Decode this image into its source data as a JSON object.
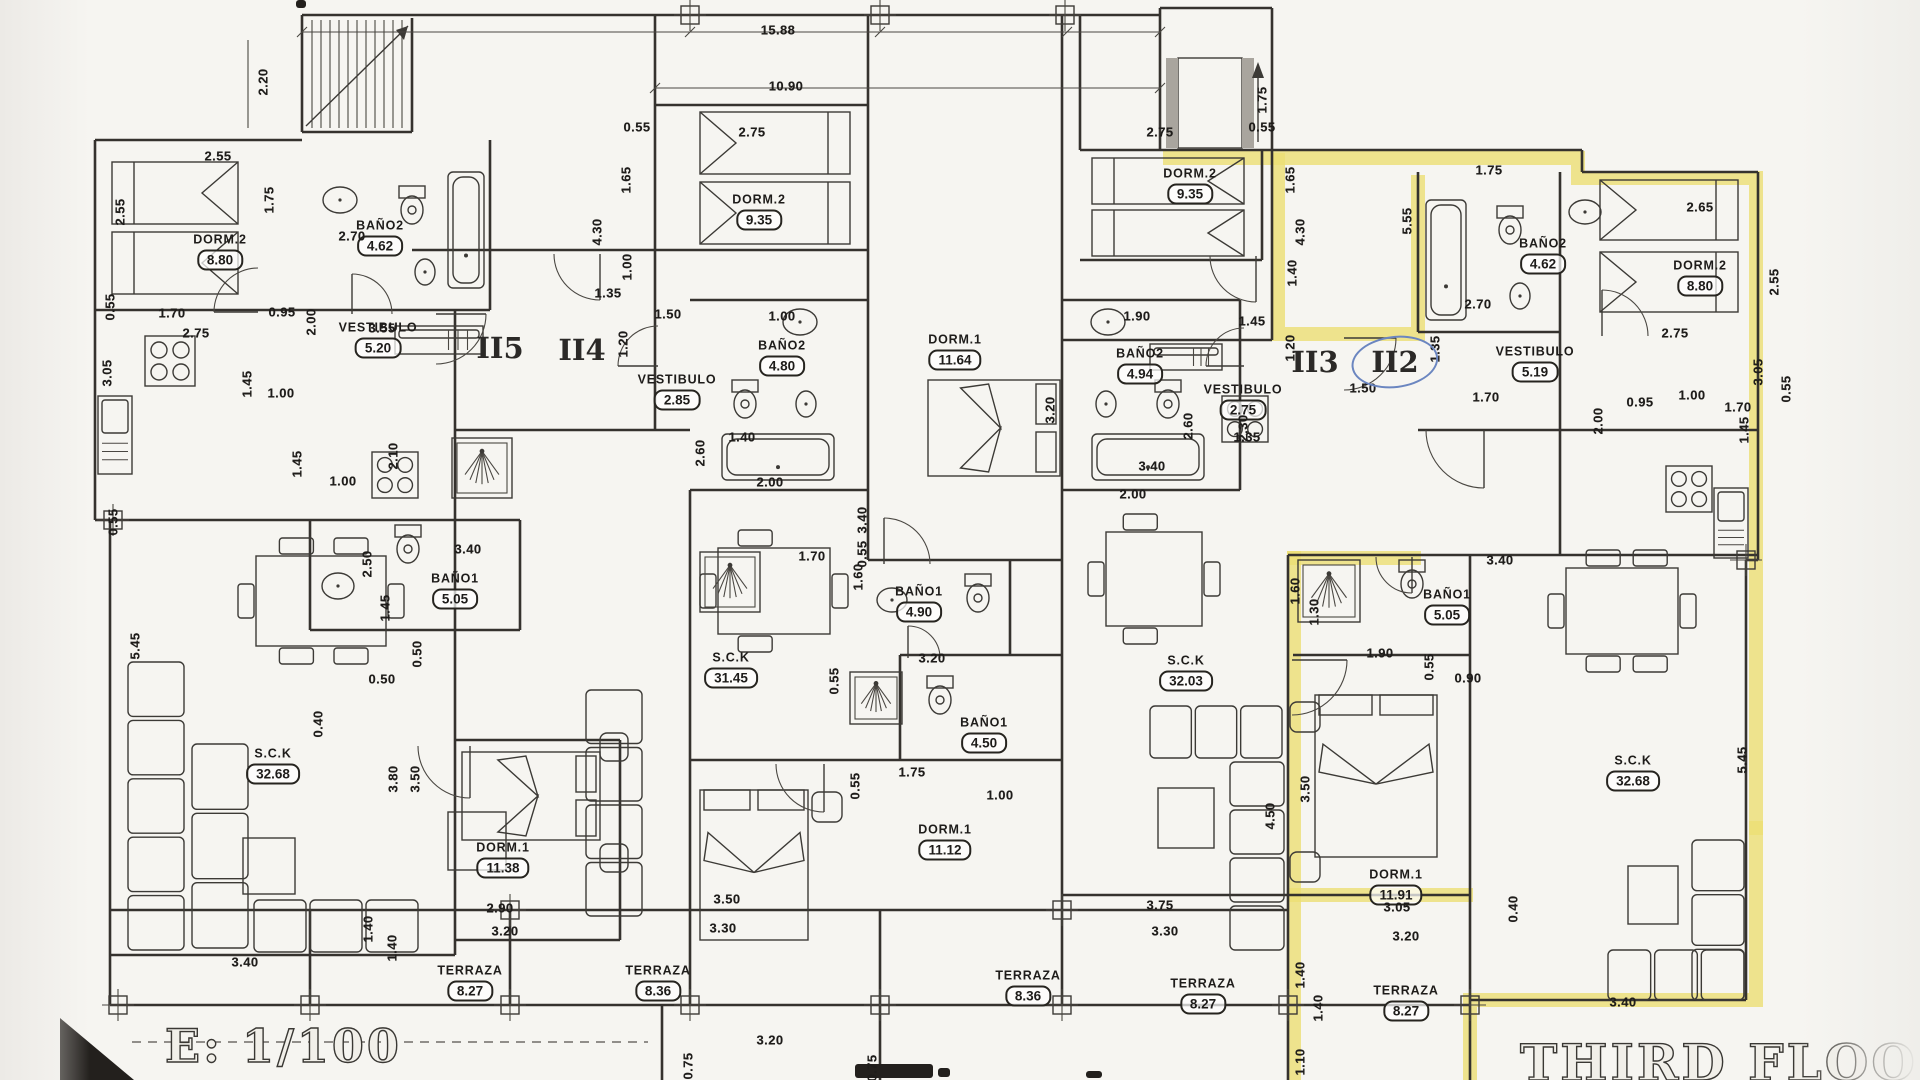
{
  "document": {
    "scale_label": "E: 1/100",
    "floor_title": "THIRD FLOOR"
  },
  "units": [
    {
      "label": "II5",
      "x": 500,
      "y": 348,
      "circled": false
    },
    {
      "label": "II4",
      "x": 582,
      "y": 350,
      "circled": false
    },
    {
      "label": "II3",
      "x": 1315,
      "y": 362,
      "circled": false
    },
    {
      "label": "II2",
      "x": 1395,
      "y": 362,
      "circled": true
    }
  ],
  "rooms": [
    {
      "name": "DORM.2",
      "area": "8.80",
      "x": 220,
      "y": 252
    },
    {
      "name": "BAÑO2",
      "area": "4.62",
      "x": 380,
      "y": 238
    },
    {
      "name": "VESTIBULO",
      "area": "5.20",
      "x": 378,
      "y": 340
    },
    {
      "name": "DORM.2",
      "area": "9.35",
      "x": 759,
      "y": 212
    },
    {
      "name": "BAÑO2",
      "area": "4.80",
      "x": 782,
      "y": 358
    },
    {
      "name": "VESTIBULO",
      "area": "2.85",
      "x": 677,
      "y": 392
    },
    {
      "name": "DORM.1",
      "area": "11.64",
      "x": 955,
      "y": 352
    },
    {
      "name": "DORM.2",
      "area": "9.35",
      "x": 1190,
      "y": 186
    },
    {
      "name": "BAÑO2",
      "area": "4.94",
      "x": 1140,
      "y": 366
    },
    {
      "name": "VESTIBULO",
      "area": "2.75",
      "x": 1243,
      "y": 402
    },
    {
      "name": "BAÑO2",
      "area": "4.62",
      "x": 1543,
      "y": 256
    },
    {
      "name": "VESTIBULO",
      "area": "5.19",
      "x": 1535,
      "y": 364
    },
    {
      "name": "DORM.2",
      "area": "8.80",
      "x": 1700,
      "y": 278
    },
    {
      "name": "BAÑO1",
      "area": "5.05",
      "x": 455,
      "y": 591
    },
    {
      "name": "S.C.K",
      "area": "32.68",
      "x": 273,
      "y": 766
    },
    {
      "name": "DORM.1",
      "area": "11.38",
      "x": 503,
      "y": 860
    },
    {
      "name": "TERRAZA",
      "area": "8.27",
      "x": 470,
      "y": 983
    },
    {
      "name": "S.C.K",
      "area": "31.45",
      "x": 731,
      "y": 670
    },
    {
      "name": "BAÑO1",
      "area": "4.90",
      "x": 919,
      "y": 604
    },
    {
      "name": "BAÑO1",
      "area": "4.50",
      "x": 984,
      "y": 735
    },
    {
      "name": "DORM.1",
      "area": "11.12",
      "x": 945,
      "y": 842
    },
    {
      "name": "TERRAZA",
      "area": "8.36",
      "x": 658,
      "y": 983
    },
    {
      "name": "S.C.K",
      "area": "32.03",
      "x": 1186,
      "y": 673
    },
    {
      "name": "BAÑO1",
      "area": "5.05",
      "x": 1447,
      "y": 607
    },
    {
      "name": "DORM.1",
      "area": "11.91",
      "x": 1396,
      "y": 887
    },
    {
      "name": "TERRAZA",
      "area": "8.36",
      "x": 1028,
      "y": 988
    },
    {
      "name": "TERRAZA",
      "area": "8.27",
      "x": 1203,
      "y": 996
    },
    {
      "name": "S.C.K",
      "area": "32.68",
      "x": 1633,
      "y": 773
    },
    {
      "name": "TERRAZA",
      "area": "8.27",
      "x": 1406,
      "y": 1003
    }
  ],
  "dimensions": [
    {
      "t": "15.88",
      "x": 778,
      "y": 30
    },
    {
      "t": "10.90",
      "x": 786,
      "y": 86
    },
    {
      "t": "2.20",
      "x": 263,
      "y": 82,
      "r": 90
    },
    {
      "t": "2.55",
      "x": 218,
      "y": 156
    },
    {
      "t": "2.55",
      "x": 120,
      "y": 212,
      "r": 90
    },
    {
      "t": "1.75",
      "x": 269,
      "y": 200,
      "r": 90
    },
    {
      "t": "2.70",
      "x": 352,
      "y": 236
    },
    {
      "t": "0.55",
      "x": 110,
      "y": 307,
      "r": 90
    },
    {
      "t": "1.70",
      "x": 172,
      "y": 313
    },
    {
      "t": "0.95",
      "x": 282,
      "y": 312
    },
    {
      "t": "2.00",
      "x": 311,
      "y": 322,
      "r": 90
    },
    {
      "t": "2.75",
      "x": 196,
      "y": 333
    },
    {
      "t": "3.55",
      "x": 382,
      "y": 328
    },
    {
      "t": "3.05",
      "x": 107,
      "y": 373,
      "r": 90
    },
    {
      "t": "1.45",
      "x": 247,
      "y": 384,
      "r": 90
    },
    {
      "t": "1.00",
      "x": 281,
      "y": 393
    },
    {
      "t": "2.10",
      "x": 393,
      "y": 456,
      "r": 90
    },
    {
      "t": "2.50",
      "x": 367,
      "y": 564,
      "r": 90
    },
    {
      "t": "3.40",
      "x": 468,
      "y": 549
    },
    {
      "t": "1.45",
      "x": 297,
      "y": 464,
      "r": 90
    },
    {
      "t": "1.00",
      "x": 343,
      "y": 481
    },
    {
      "t": "1.45",
      "x": 385,
      "y": 608,
      "r": 90
    },
    {
      "t": "0.50",
      "x": 382,
      "y": 679
    },
    {
      "t": "0.50",
      "x": 417,
      "y": 654,
      "r": 90
    },
    {
      "t": "0.55",
      "x": 113,
      "y": 522,
      "r": 90
    },
    {
      "t": "5.45",
      "x": 135,
      "y": 646,
      "r": 90
    },
    {
      "t": "3.80",
      "x": 393,
      "y": 779,
      "r": 90
    },
    {
      "t": "3.50",
      "x": 415,
      "y": 779,
      "r": 90
    },
    {
      "t": "0.40",
      "x": 318,
      "y": 724,
      "r": 90
    },
    {
      "t": "3.40",
      "x": 245,
      "y": 962
    },
    {
      "t": "1.40",
      "x": 368,
      "y": 929,
      "r": 90
    },
    {
      "t": "1.40",
      "x": 392,
      "y": 948,
      "r": 90
    },
    {
      "t": "2.90",
      "x": 500,
      "y": 908
    },
    {
      "t": "3.20",
      "x": 505,
      "y": 931
    },
    {
      "t": "0.55",
      "x": 637,
      "y": 127
    },
    {
      "t": "2.75",
      "x": 752,
      "y": 132
    },
    {
      "t": "1.65",
      "x": 626,
      "y": 180,
      "r": 90
    },
    {
      "t": "4.30",
      "x": 597,
      "y": 232,
      "r": 90
    },
    {
      "t": "1.00",
      "x": 627,
      "y": 267,
      "r": 90
    },
    {
      "t": "1.50",
      "x": 668,
      "y": 314
    },
    {
      "t": "1.00",
      "x": 782,
      "y": 316
    },
    {
      "t": "1.20",
      "x": 623,
      "y": 344,
      "r": 90
    },
    {
      "t": "1.35",
      "x": 608,
      "y": 293
    },
    {
      "t": "1.40",
      "x": 742,
      "y": 437
    },
    {
      "t": "2.60",
      "x": 700,
      "y": 453,
      "r": 90
    },
    {
      "t": "2.00",
      "x": 770,
      "y": 482
    },
    {
      "t": "3.40",
      "x": 862,
      "y": 520,
      "r": 90
    },
    {
      "t": "3.20",
      "x": 1050,
      "y": 410,
      "r": 90
    },
    {
      "t": "1.70",
      "x": 812,
      "y": 556
    },
    {
      "t": "0.55",
      "x": 862,
      "y": 554,
      "r": 90
    },
    {
      "t": "1.60",
      "x": 858,
      "y": 577,
      "r": 90
    },
    {
      "t": "3.20",
      "x": 932,
      "y": 658
    },
    {
      "t": "0.55",
      "x": 834,
      "y": 681,
      "r": 90
    },
    {
      "t": "1.75",
      "x": 912,
      "y": 772
    },
    {
      "t": "0.55",
      "x": 855,
      "y": 786,
      "r": 90
    },
    {
      "t": "1.00",
      "x": 1000,
      "y": 795
    },
    {
      "t": "3.50",
      "x": 727,
      "y": 899
    },
    {
      "t": "3.30",
      "x": 723,
      "y": 928
    },
    {
      "t": "3.20",
      "x": 770,
      "y": 1040
    },
    {
      "t": "0.75",
      "x": 688,
      "y": 1066,
      "r": 90
    },
    {
      "t": "0.75",
      "x": 872,
      "y": 1068,
      "r": 90
    },
    {
      "t": "2.75",
      "x": 1160,
      "y": 132
    },
    {
      "t": "0.55",
      "x": 1262,
      "y": 127
    },
    {
      "t": "1.65",
      "x": 1290,
      "y": 180,
      "r": 90
    },
    {
      "t": "4.30",
      "x": 1300,
      "y": 232,
      "r": 90
    },
    {
      "t": "1.90",
      "x": 1137,
      "y": 316
    },
    {
      "t": "1.45",
      "x": 1252,
      "y": 321
    },
    {
      "t": "1.40",
      "x": 1292,
      "y": 273,
      "r": 90
    },
    {
      "t": "1.20",
      "x": 1290,
      "y": 348,
      "r": 90
    },
    {
      "t": "1.35",
      "x": 1247,
      "y": 437
    },
    {
      "t": "2.60",
      "x": 1188,
      "y": 426,
      "r": 90
    },
    {
      "t": "2.00",
      "x": 1133,
      "y": 494
    },
    {
      "t": "2.30",
      "x": 1243,
      "y": 428,
      "r": 90
    },
    {
      "t": "3.40",
      "x": 1152,
      "y": 466
    },
    {
      "t": "1.60",
      "x": 1295,
      "y": 591,
      "r": 90
    },
    {
      "t": "1.30",
      "x": 1314,
      "y": 612,
      "r": 90
    },
    {
      "t": "3.40",
      "x": 1500,
      "y": 560
    },
    {
      "t": "1.90",
      "x": 1380,
      "y": 653
    },
    {
      "t": "0.55",
      "x": 1429,
      "y": 667,
      "r": 90
    },
    {
      "t": "0.90",
      "x": 1468,
      "y": 678
    },
    {
      "t": "3.75",
      "x": 1160,
      "y": 905
    },
    {
      "t": "3.30",
      "x": 1165,
      "y": 931
    },
    {
      "t": "3.50",
      "x": 1305,
      "y": 789,
      "r": 90
    },
    {
      "t": "4.50",
      "x": 1270,
      "y": 816,
      "r": 90
    },
    {
      "t": "3.05",
      "x": 1397,
      "y": 907
    },
    {
      "t": "3.20",
      "x": 1406,
      "y": 936
    },
    {
      "t": "0.40",
      "x": 1513,
      "y": 909,
      "r": 90
    },
    {
      "t": "1.40",
      "x": 1300,
      "y": 975,
      "r": 90
    },
    {
      "t": "1.40",
      "x": 1318,
      "y": 1008,
      "r": 90
    },
    {
      "t": "1.10",
      "x": 1300,
      "y": 1062,
      "r": 90
    },
    {
      "t": "3.40",
      "x": 1623,
      "y": 1002
    },
    {
      "t": "5.45",
      "x": 1742,
      "y": 760,
      "r": 90
    },
    {
      "t": "1.75",
      "x": 1262,
      "y": 100,
      "r": 90
    },
    {
      "t": "1.75",
      "x": 1489,
      "y": 170
    },
    {
      "t": "5.55",
      "x": 1407,
      "y": 221,
      "r": 90
    },
    {
      "t": "2.70",
      "x": 1478,
      "y": 304
    },
    {
      "t": "1.35",
      "x": 1435,
      "y": 349,
      "r": 90
    },
    {
      "t": "1.50",
      "x": 1363,
      "y": 388
    },
    {
      "t": "1.70",
      "x": 1486,
      "y": 397
    },
    {
      "t": "2.65",
      "x": 1700,
      "y": 207
    },
    {
      "t": "2.55",
      "x": 1774,
      "y": 282,
      "r": 90
    },
    {
      "t": "0.95",
      "x": 1640,
      "y": 402
    },
    {
      "t": "1.70",
      "x": 1738,
      "y": 407
    },
    {
      "t": "0.55",
      "x": 1786,
      "y": 389,
      "r": 90
    },
    {
      "t": "2.00",
      "x": 1598,
      "y": 421,
      "r": 90
    },
    {
      "t": "2.75",
      "x": 1675,
      "y": 333
    },
    {
      "t": "3.05",
      "x": 1758,
      "y": 372,
      "r": 90
    },
    {
      "t": "1.45",
      "x": 1744,
      "y": 430,
      "r": 90
    },
    {
      "t": "1.00",
      "x": 1692,
      "y": 395
    }
  ]
}
